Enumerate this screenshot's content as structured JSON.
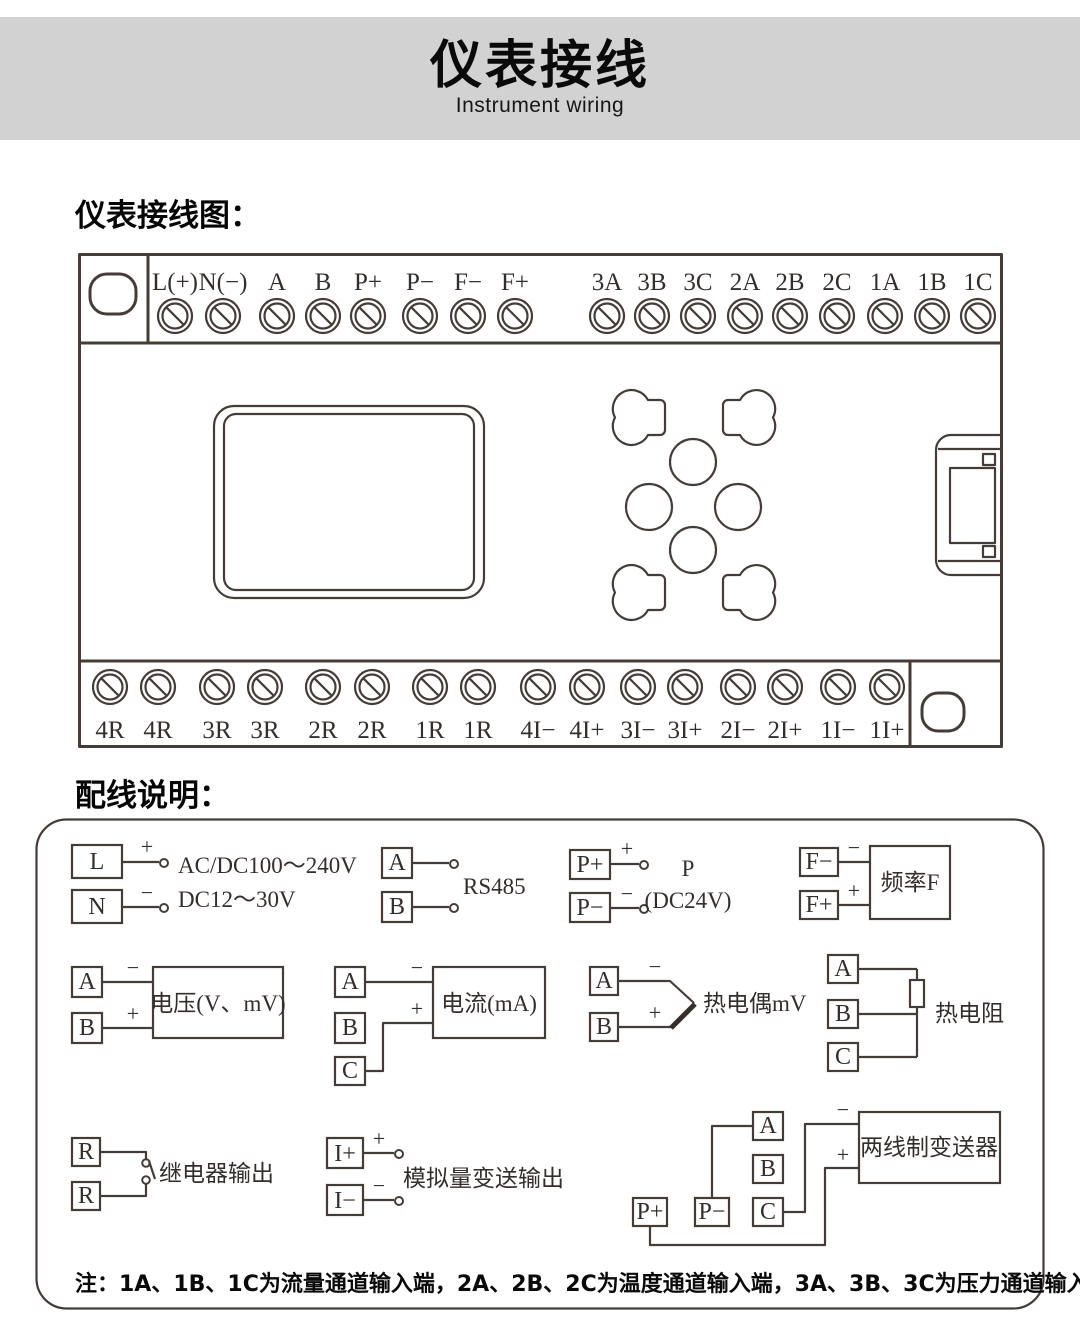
{
  "header": {
    "title": "仪表接线",
    "subtitle": "Instrument wiring"
  },
  "sections": {
    "diagram_heading": "仪表接线图：",
    "wiring_heading": "配线说明："
  },
  "signs": {
    "plus": "+",
    "minus": "−"
  },
  "diagram": {
    "top_terminals": [
      "L(+)",
      "N(−)",
      "A",
      "B",
      "P+",
      "P−",
      "F−",
      "F+",
      "3A",
      "3B",
      "3C",
      "2A",
      "2B",
      "2C",
      "1A",
      "1B",
      "1C"
    ],
    "bottom_terminals": [
      "4R",
      "4R",
      "3R",
      "3R",
      "2R",
      "2R",
      "1R",
      "1R",
      "4I−",
      "4I+",
      "3I−",
      "3I+",
      "2I−",
      "2I+",
      "1I−",
      "1I+"
    ]
  },
  "wiring": {
    "power": {
      "t1": "L",
      "t2": "N",
      "line1": "AC/DC100～240V",
      "line2": "DC12～30V"
    },
    "rs485": {
      "t1": "A",
      "t2": "B",
      "label": "RS485"
    },
    "p24": {
      "t1": "P+",
      "t2": "P−",
      "label1": "P",
      "label2": "(DC24V)"
    },
    "freq": {
      "t1": "F−",
      "t2": "F+",
      "label": "频率F"
    },
    "voltage": {
      "t1": "A",
      "t2": "B",
      "label": "电压(V、mV)"
    },
    "current": {
      "t1": "A",
      "t2": "B",
      "t3": "C",
      "label": "电流(mA)"
    },
    "thermocouple": {
      "t1": "A",
      "t2": "B",
      "label": "热电偶mV"
    },
    "rtd": {
      "t1": "A",
      "t2": "B",
      "t3": "C",
      "label": "热电阻"
    },
    "relay": {
      "t1": "R",
      "t2": "R",
      "label": "继电器输出"
    },
    "analog_out": {
      "t1": "I+",
      "t2": "I−",
      "label": "模拟量变送输出"
    },
    "transmitter": {
      "tA": "A",
      "tB": "B",
      "tC": "C",
      "tPp": "P+",
      "tPm": "P−",
      "label": "两线制变送器"
    },
    "note": "注：1A、1B、1C为流量通道输入端，2A、2B、2C为温度通道输入端，3A、3B、3C为压力通道输入端。"
  }
}
